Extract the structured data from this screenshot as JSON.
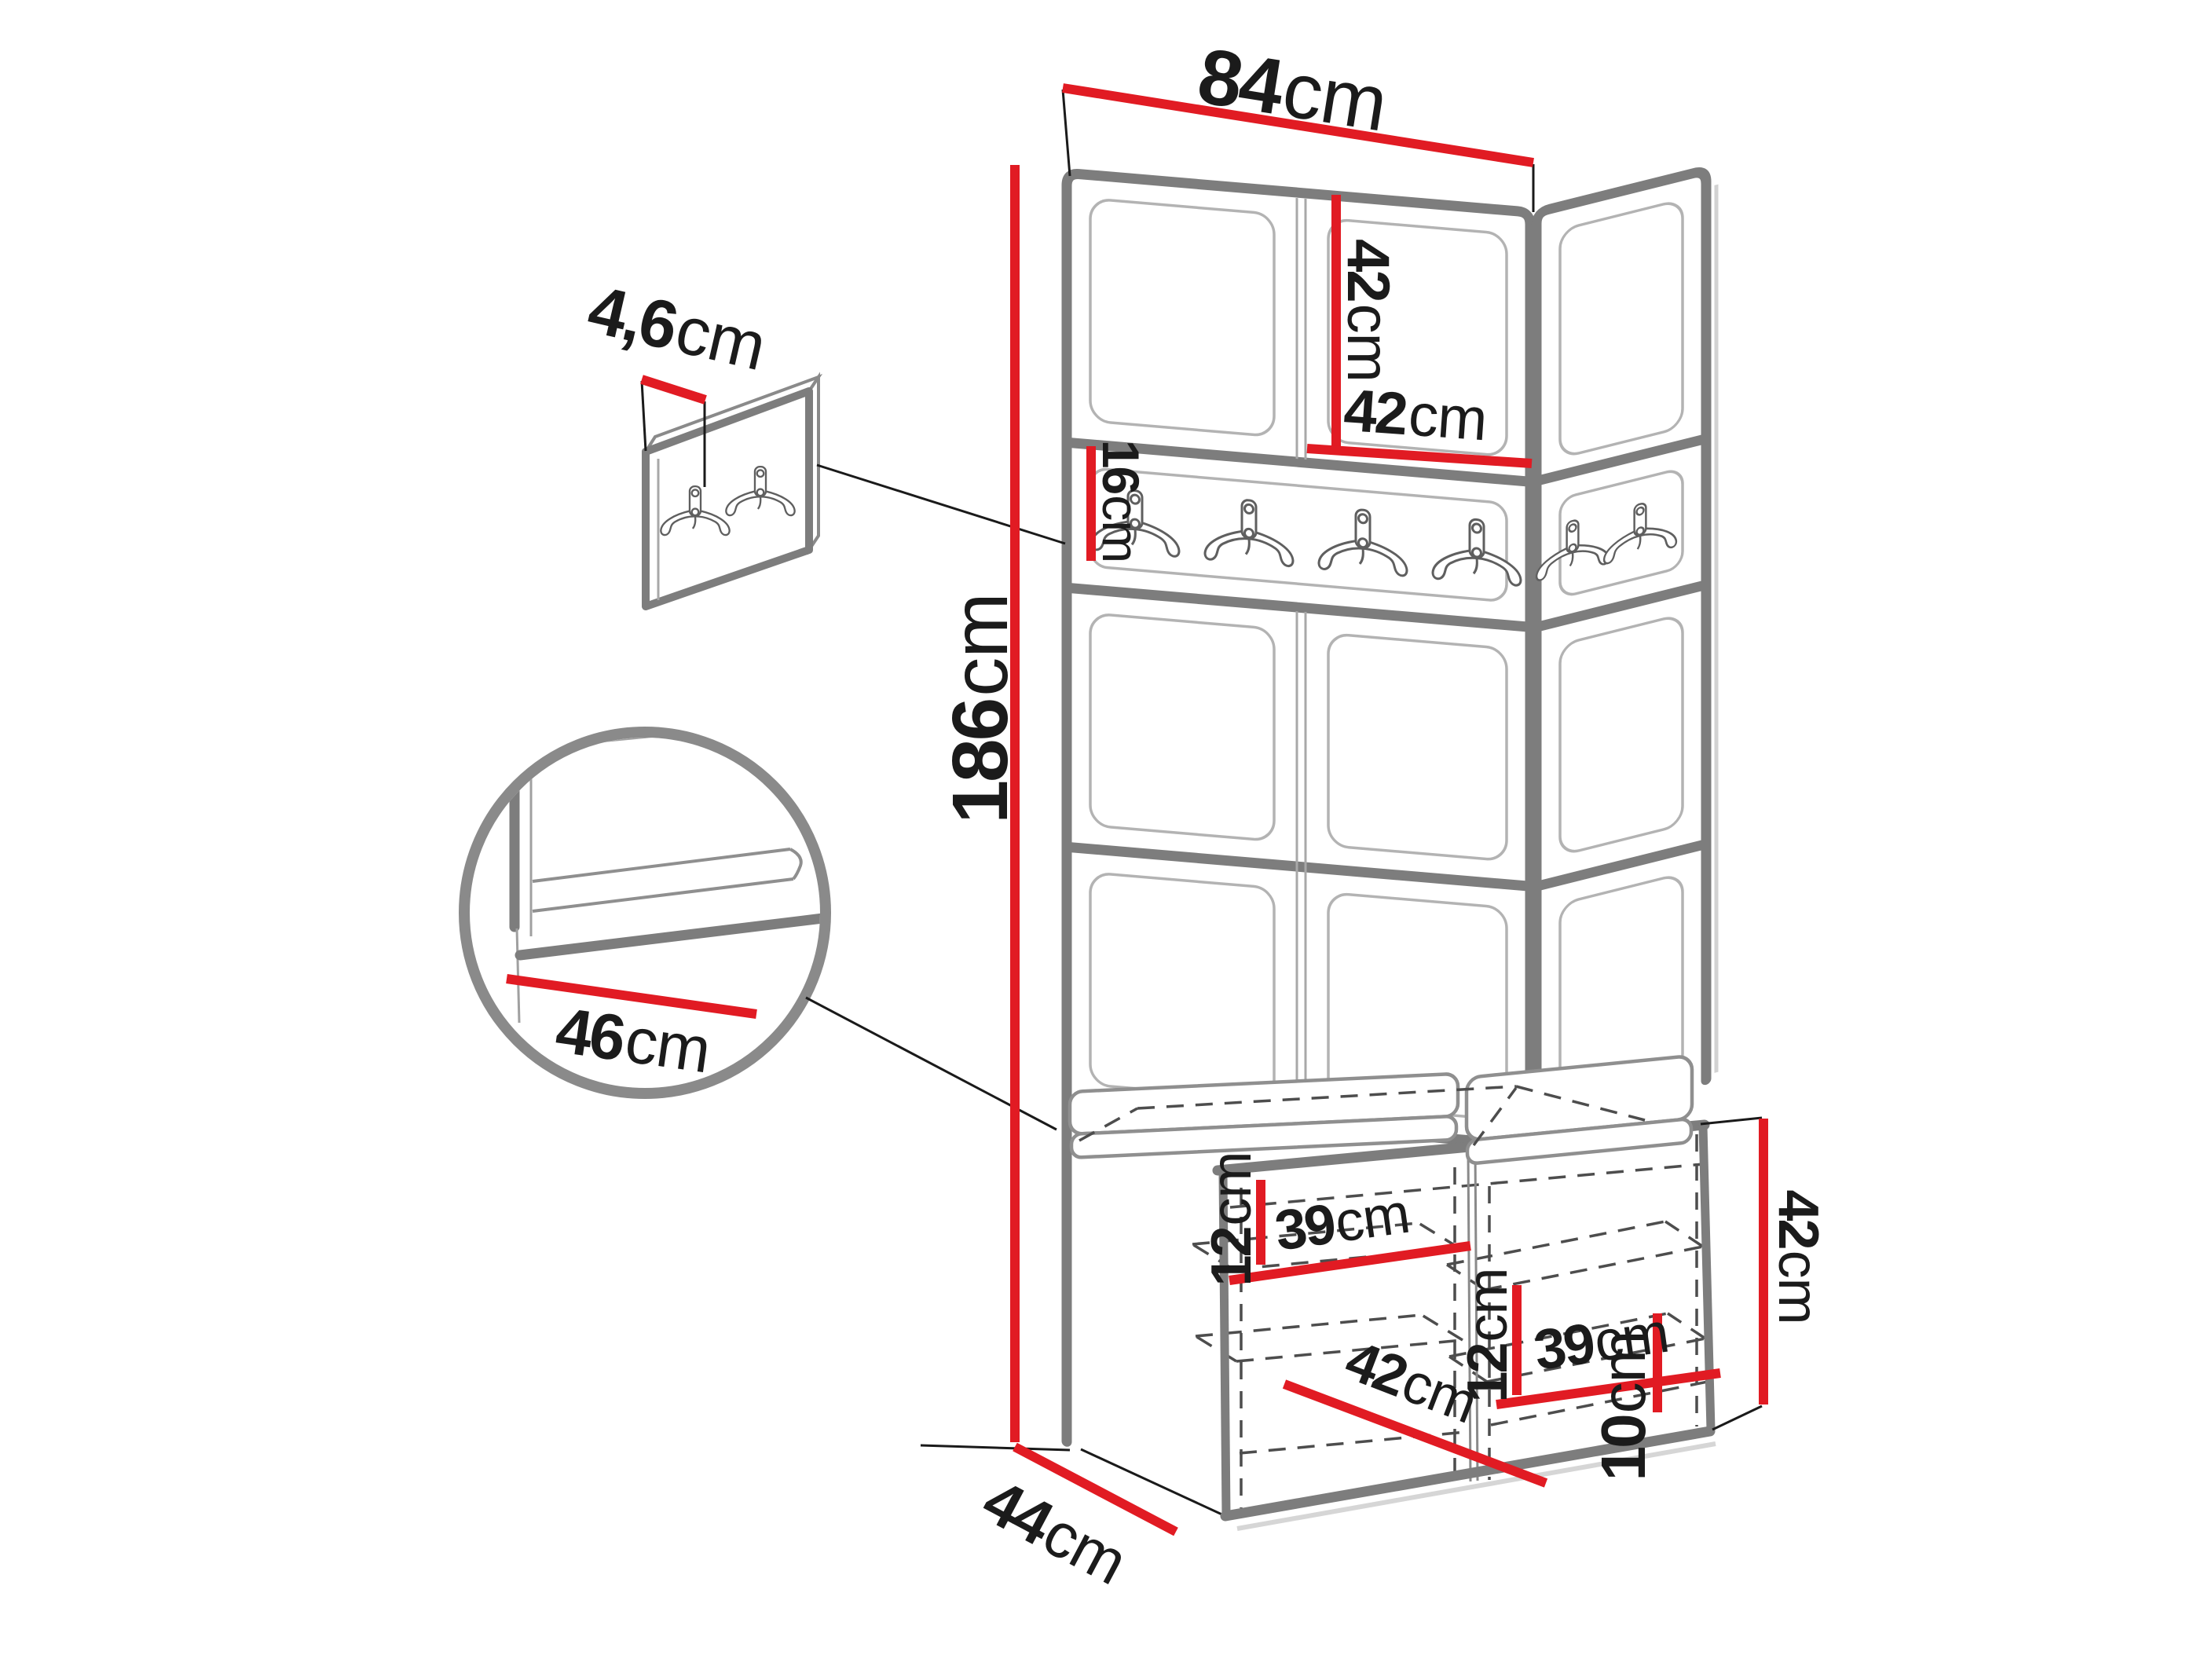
{
  "diagram": {
    "type": "furniture-dimension-diagram",
    "subject": "hallway corner set: upholstered wall panels, coat-hook rail and shoe bench with cushions",
    "unit_of_measure": "cm"
  },
  "dimensions": {
    "total_width": {
      "value": "84",
      "unit": "cm"
    },
    "total_height": {
      "value": "186",
      "unit": "cm"
    },
    "upper_cabinet_height": {
      "value": "42",
      "unit": "cm"
    },
    "upper_cabinet_width": {
      "value": "42",
      "unit": "cm"
    },
    "hook_panel_thickness": {
      "value": "4,6",
      "unit": "cm"
    },
    "hook_rail_height": {
      "value": "16",
      "unit": "cm"
    },
    "seat_depth": {
      "value": "46",
      "unit": "cm"
    },
    "left_shelf_spacing": {
      "value": "12",
      "unit": "cm"
    },
    "left_shelf_width": {
      "value": "39",
      "unit": "cm"
    },
    "right_shelf_spacing": {
      "value": "12",
      "unit": "cm"
    },
    "right_shelf_width": {
      "value": "39",
      "unit": "cm"
    },
    "bench_compartment_depth": {
      "value": "42",
      "unit": "cm"
    },
    "bench_height": {
      "value": "42",
      "unit": "cm"
    },
    "plinth_height": {
      "value": "10",
      "unit": "cm"
    },
    "bench_depth": {
      "value": "44",
      "unit": "cm"
    }
  },
  "colors": {
    "dimension_red": "#e11b23",
    "outline_gray": "#7d7d7d",
    "thin_gray": "#a5a5a5",
    "dash_gray": "#4d4d4d",
    "label_black": "#1b1b1b"
  }
}
